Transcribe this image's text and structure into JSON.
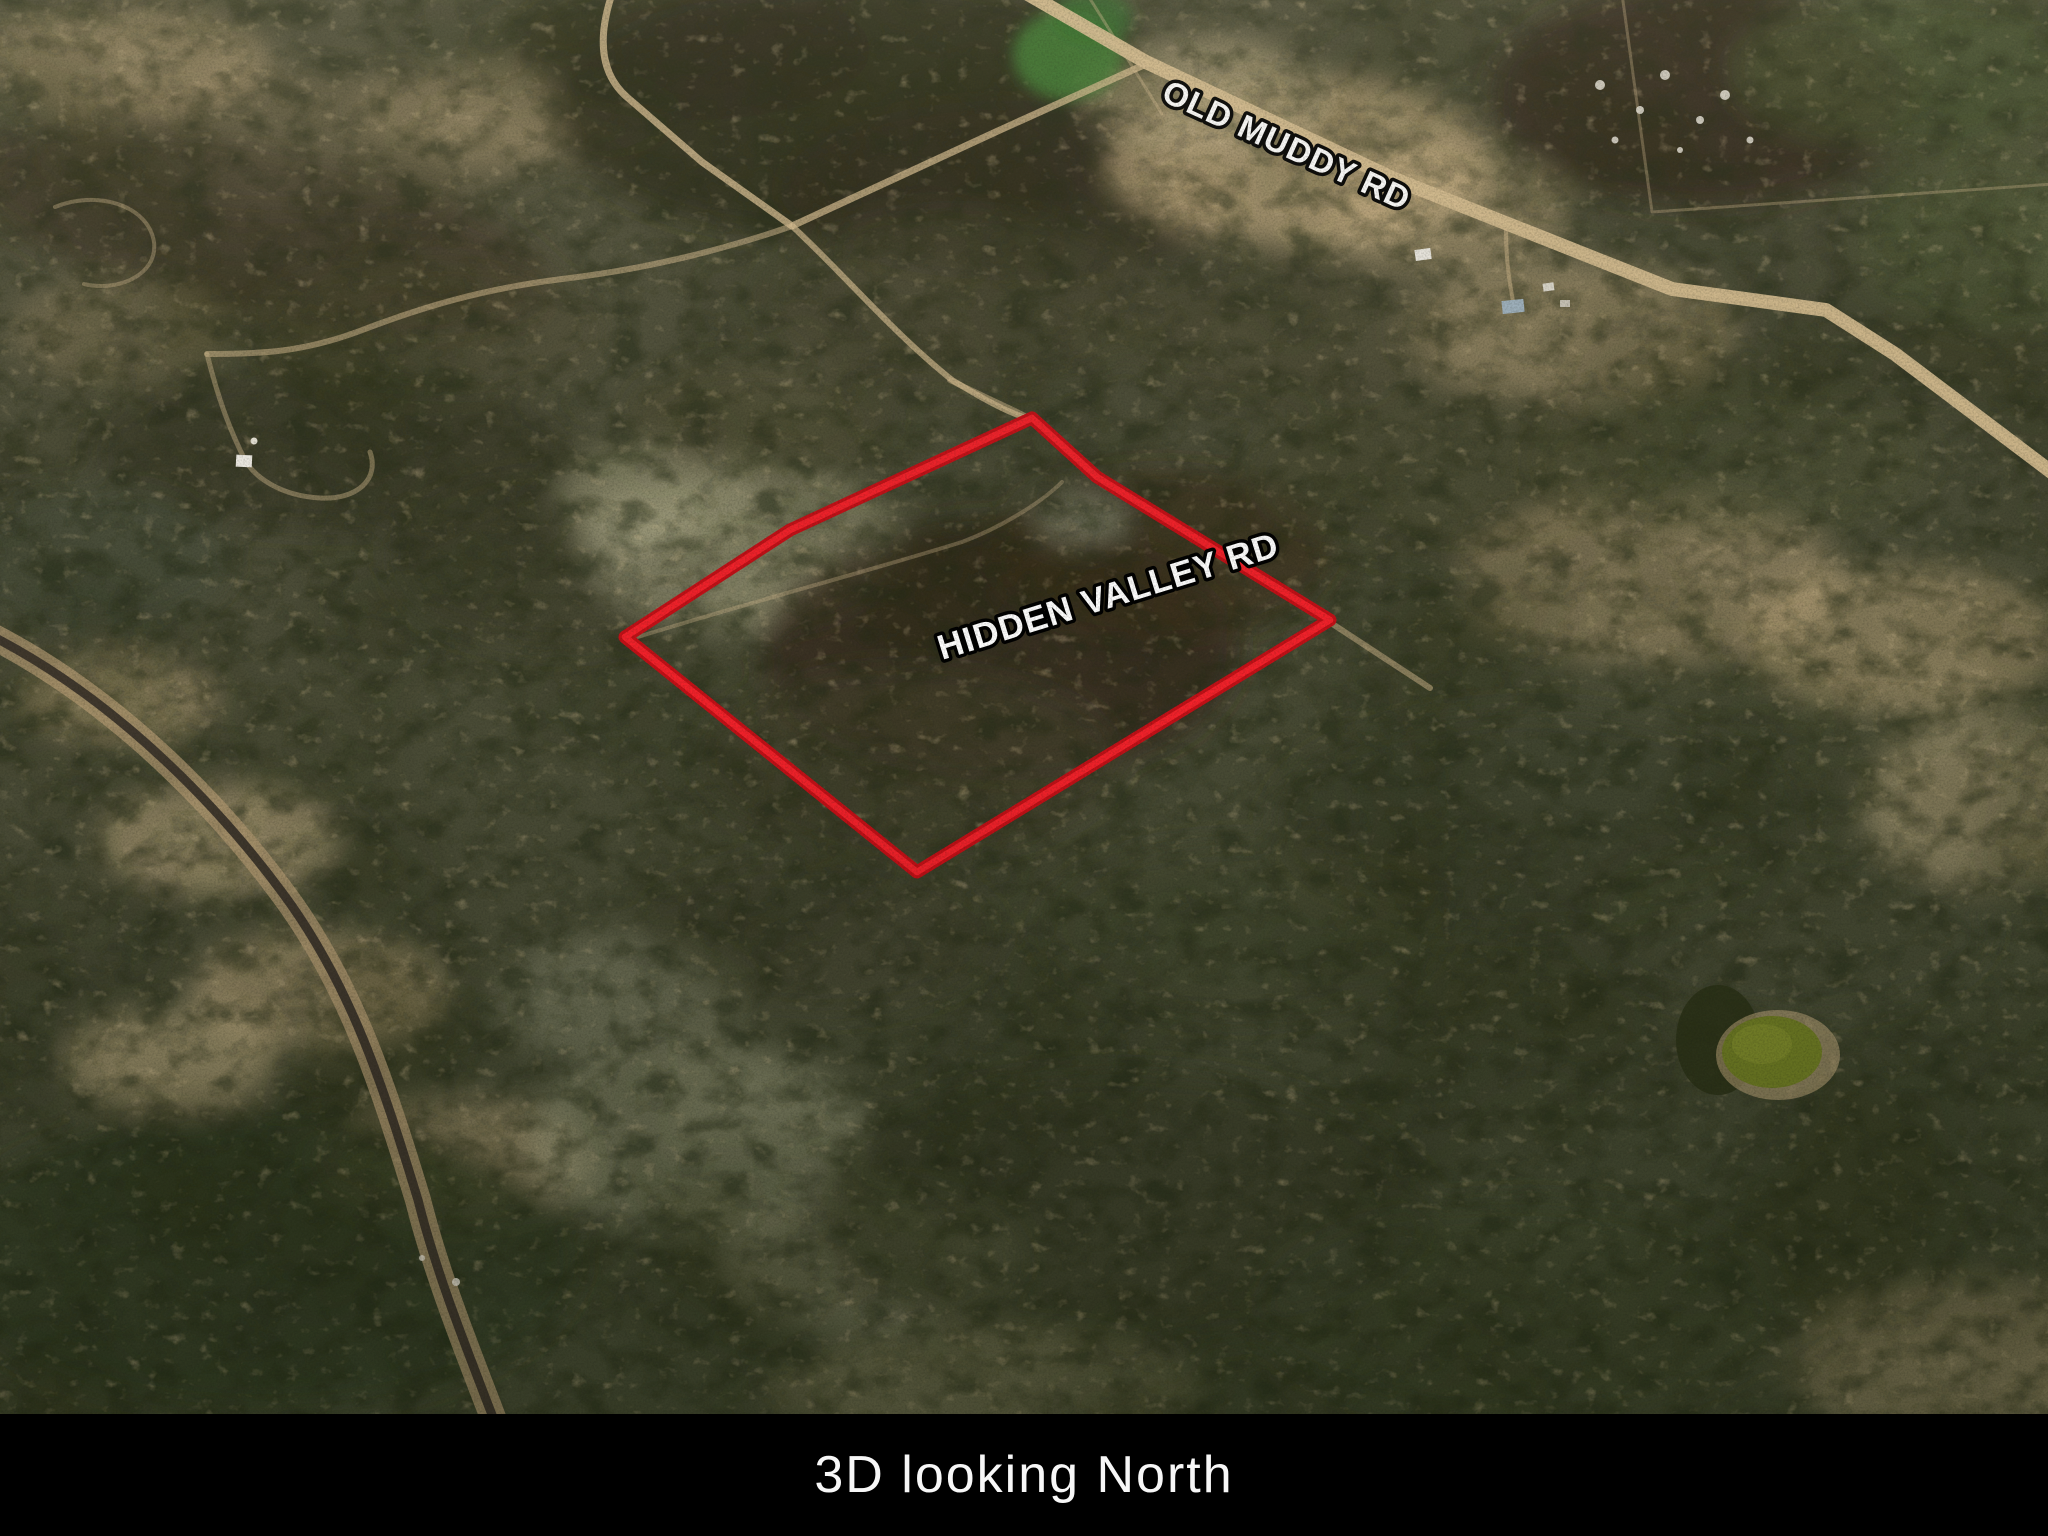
{
  "map": {
    "road_labels": {
      "old_muddy": "OLD MUDDY RD",
      "hidden_valley": "HIDDEN VALLEY RD"
    },
    "boundary": {
      "points": "1032,418 1097,477 1330,620 917,872 625,637 790,530"
    }
  },
  "caption": {
    "text": "3D looking North"
  },
  "theme": {
    "boundary_red": "#f2212a",
    "boundary_red_dark": "#c31017",
    "label_text": "#ffffff",
    "label_stroke": "#000000",
    "caption_bg": "#000000",
    "caption_text": "#f7f7f7",
    "road_tan": "#d3ba8e",
    "rail_dark": "#3a332a",
    "pond_green": "#6e7b24"
  }
}
